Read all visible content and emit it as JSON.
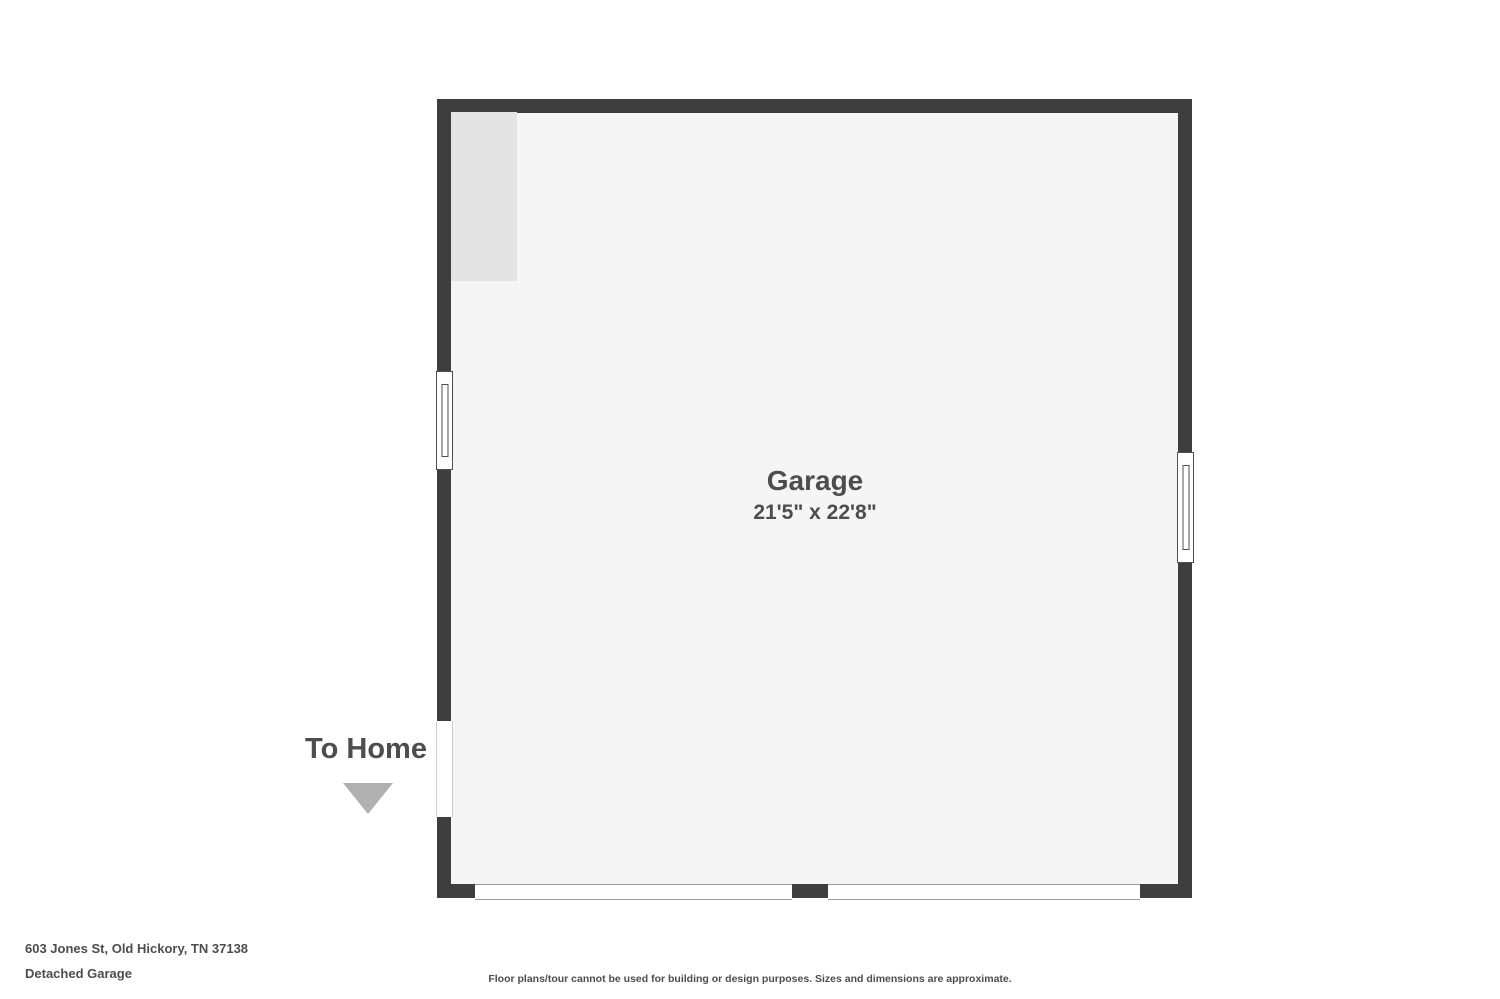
{
  "colors": {
    "background": "#ffffff",
    "wall": "#3e3e3e",
    "floor": "#f5f5f5",
    "storage_area": "#e4e4e4",
    "arrow": "#b0b0b0",
    "text": "#4d4d4d"
  },
  "plan": {
    "room_name": "Garage",
    "room_dimensions": "21'5\" x 22'8\"",
    "features": {
      "left_window": "window",
      "right_window": "window",
      "entry_opening": "opening to home",
      "garage_door_openings": 2
    }
  },
  "annotations": {
    "to_home_label": "To Home",
    "to_home_arrow": "triangle-down"
  },
  "footer": {
    "address": "603 Jones St, Old Hickory, TN 37138",
    "plan_name": "Detached Garage",
    "disclaimer": "Floor plans/tour cannot be used for building or design purposes. Sizes and dimensions are approximate."
  }
}
